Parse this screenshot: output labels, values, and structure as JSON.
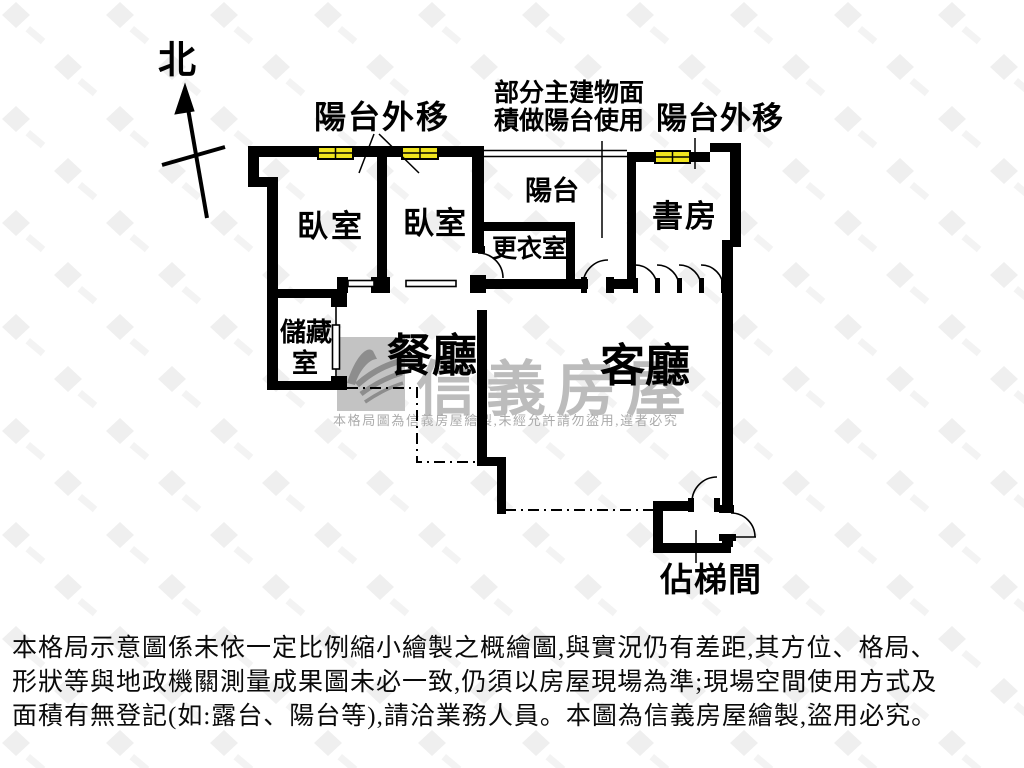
{
  "compass": {
    "north_label": "北"
  },
  "annotations": {
    "balcony_shift_left": "陽台外移",
    "balcony_shift_right": "陽台外移",
    "area_note_line1": "部分主建物面",
    "area_note_line2": "積做陽台使用"
  },
  "rooms": {
    "bedroom_left": "臥室",
    "bedroom_mid": "臥室",
    "balcony": "陽台",
    "dressing_room": "更衣室",
    "study": "書房",
    "storage_line1": "儲藏",
    "storage_line2": "室",
    "dining": "餐廳",
    "living": "客廳",
    "stairwell": "佔梯間"
  },
  "watermark": {
    "brand": "信義房屋",
    "notice": "本格局圖為信義房屋繪製,未經允許請勿盜用,違者必究"
  },
  "disclaimer": {
    "line1": "本格局示意圖係未依一定比例縮小繪製之概繪圖,與實況仍有差距,其方位、格局、",
    "line2": "形狀等與地政機關測量成果圖未必一致,仍須以房屋現場為準;現場空間使用方式及",
    "line3": "面積有無登記(如:露台、陽台等),請洽業務人員。本圖為信義房屋繪製,盜用必究。"
  },
  "colors": {
    "wall": "#000000",
    "window_fill": "#f0e41e",
    "watermark_gray": "#bcbcbc",
    "notice_gray": "#ababab"
  }
}
